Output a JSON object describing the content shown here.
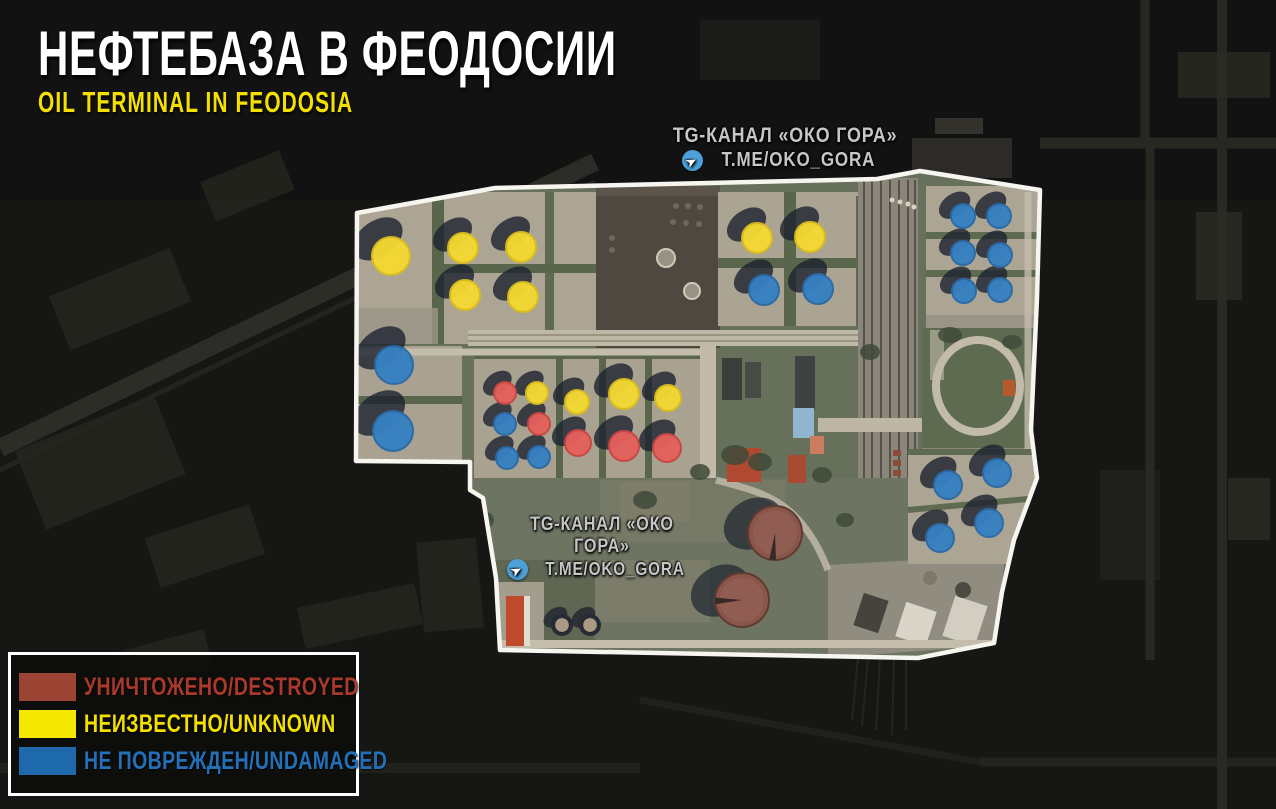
{
  "title": "НЕФТЕБАЗА В ФЕОДОСИИ",
  "subtitle": "OIL TERMINAL IN FEODOSIA",
  "watermarks": [
    {
      "line1": "TG-КАНАЛ «ОКО ГОРА»",
      "line2": "T.ME/OKO_GORA"
    },
    {
      "line1": "TG-КАНАЛ «ОКО ГОРА»",
      "line2": "T.ME/OKO_GORA"
    }
  ],
  "legend": {
    "items": [
      {
        "status": "destroyed",
        "label": "УНИЧТОЖЕНО/DESTROYED",
        "color": "#9c4433",
        "text_color": "#a8392b"
      },
      {
        "status": "unknown",
        "label": "НЕИЗВЕСТНО/UNKNOWN",
        "color": "#f5e800",
        "text_color": "#f3df00"
      },
      {
        "status": "undamaged",
        "label": "НЕ ПОВРЕЖДЕН/UNDAMAGED",
        "color": "#1e68ac",
        "text_color": "#2470b8"
      }
    ]
  },
  "map": {
    "marker_colors": {
      "destroyed": "#e4605c",
      "unknown": "#f3d832",
      "undamaged": "#3780c2"
    },
    "marker_strokes": {
      "destroyed": "#c84743",
      "unknown": "#d9bc1f",
      "undamaged": "#2b6aa6"
    },
    "tanks": [
      {
        "x": 391,
        "y": 256,
        "r": 19,
        "status": "unknown"
      },
      {
        "x": 463,
        "y": 248,
        "r": 15,
        "status": "unknown"
      },
      {
        "x": 521,
        "y": 247,
        "r": 15,
        "status": "unknown"
      },
      {
        "x": 465,
        "y": 295,
        "r": 15,
        "status": "unknown"
      },
      {
        "x": 523,
        "y": 297,
        "r": 15,
        "status": "unknown"
      },
      {
        "x": 757,
        "y": 238,
        "r": 15,
        "status": "unknown"
      },
      {
        "x": 810,
        "y": 237,
        "r": 15,
        "status": "unknown"
      },
      {
        "x": 537,
        "y": 393,
        "r": 11,
        "status": "unknown"
      },
      {
        "x": 577,
        "y": 402,
        "r": 12,
        "status": "unknown"
      },
      {
        "x": 624,
        "y": 394,
        "r": 15,
        "status": "unknown"
      },
      {
        "x": 668,
        "y": 398,
        "r": 13,
        "status": "unknown"
      },
      {
        "x": 505,
        "y": 393,
        "r": 11,
        "status": "destroyed"
      },
      {
        "x": 539,
        "y": 424,
        "r": 11,
        "status": "destroyed"
      },
      {
        "x": 578,
        "y": 443,
        "r": 13,
        "status": "destroyed"
      },
      {
        "x": 624,
        "y": 446,
        "r": 15,
        "status": "destroyed"
      },
      {
        "x": 667,
        "y": 448,
        "r": 14,
        "status": "destroyed"
      },
      {
        "x": 394,
        "y": 365,
        "r": 19,
        "status": "undamaged"
      },
      {
        "x": 393,
        "y": 431,
        "r": 20,
        "status": "undamaged"
      },
      {
        "x": 505,
        "y": 424,
        "r": 11,
        "status": "undamaged"
      },
      {
        "x": 507,
        "y": 458,
        "r": 11,
        "status": "undamaged"
      },
      {
        "x": 539,
        "y": 457,
        "r": 11,
        "status": "undamaged"
      },
      {
        "x": 764,
        "y": 290,
        "r": 15,
        "status": "undamaged"
      },
      {
        "x": 818,
        "y": 289,
        "r": 15,
        "status": "undamaged"
      },
      {
        "x": 963,
        "y": 216,
        "r": 12,
        "status": "undamaged"
      },
      {
        "x": 999,
        "y": 216,
        "r": 12,
        "status": "undamaged"
      },
      {
        "x": 963,
        "y": 253,
        "r": 12,
        "status": "undamaged"
      },
      {
        "x": 1000,
        "y": 255,
        "r": 12,
        "status": "undamaged"
      },
      {
        "x": 964,
        "y": 291,
        "r": 12,
        "status": "undamaged"
      },
      {
        "x": 1000,
        "y": 290,
        "r": 12,
        "status": "undamaged"
      },
      {
        "x": 948,
        "y": 485,
        "r": 14,
        "status": "undamaged"
      },
      {
        "x": 997,
        "y": 473,
        "r": 14,
        "status": "undamaged"
      },
      {
        "x": 940,
        "y": 538,
        "r": 14,
        "status": "undamaged"
      },
      {
        "x": 989,
        "y": 523,
        "r": 14,
        "status": "undamaged"
      }
    ],
    "unmarked_tanks": [
      {
        "x": 775,
        "y": 533,
        "r": 27,
        "type": "burnt_roof",
        "wedge_deg": 95
      },
      {
        "x": 742,
        "y": 600,
        "r": 27,
        "type": "burnt_roof",
        "wedge_deg": 178
      },
      {
        "x": 562,
        "y": 625,
        "r": 11,
        "type": "dark_top"
      },
      {
        "x": 590,
        "y": 625,
        "r": 11,
        "type": "dark_top"
      }
    ]
  }
}
